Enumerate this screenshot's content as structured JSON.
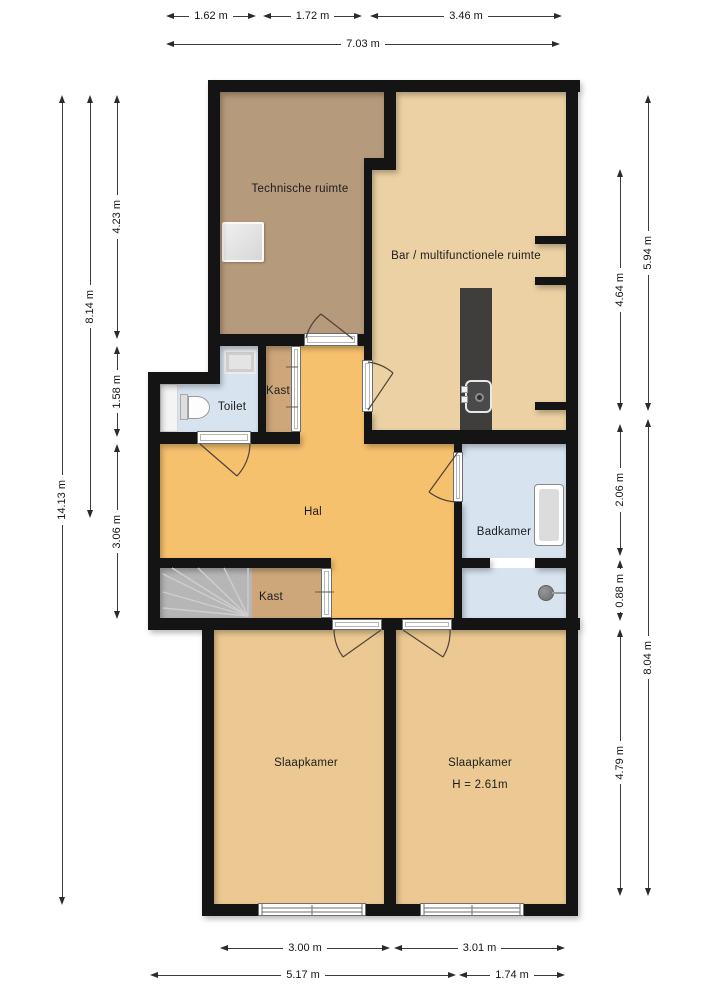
{
  "rooms": {
    "technische_ruimte": "Technische ruimte",
    "bar": "Bar / multifunctionele ruimte",
    "toilet": "Toilet",
    "kast_top": "Kast",
    "hal": "Hal",
    "badkamer": "Badkamer",
    "kast_bottom": "Kast",
    "slaapkamer_left": "Slaapkamer",
    "slaapkamer_right": "Slaapkamer",
    "slaapkamer_right_height": "H = 2.61m"
  },
  "dims": {
    "top1": "1.62 m",
    "top2": "1.72 m",
    "top3": "3.46 m",
    "top_total": "7.03 m",
    "left_total": "14.13 m",
    "left_mid": "8.14 m",
    "left1": "4.23 m",
    "left2": "1.58 m",
    "left3": "3.06 m",
    "right_top": "5.94 m",
    "right1": "4.64 m",
    "right2": "2.06 m",
    "right3": "0.88 m",
    "right4": "4.79 m",
    "right_bottom": "8.04 m",
    "bottom1": "3.00 m",
    "bottom2": "3.01 m",
    "bottom_left": "5.17 m",
    "bottom_right": "1.74 m"
  },
  "fixtures": [
    "appliance",
    "wash-basin",
    "toilet",
    "bar-counter",
    "counter-sink",
    "bathtub",
    "shower-head",
    "staircase"
  ],
  "colors": {
    "wall": "#141414",
    "technische": "#b69a7c",
    "bar": "#ebd1a3",
    "hal": "#f6c16d",
    "kast": "#cda77a",
    "slaapkamer": "#ecc992",
    "water": "#d7e3ef",
    "counter": "#403e3c",
    "stairs": "#b6b6b6"
  }
}
